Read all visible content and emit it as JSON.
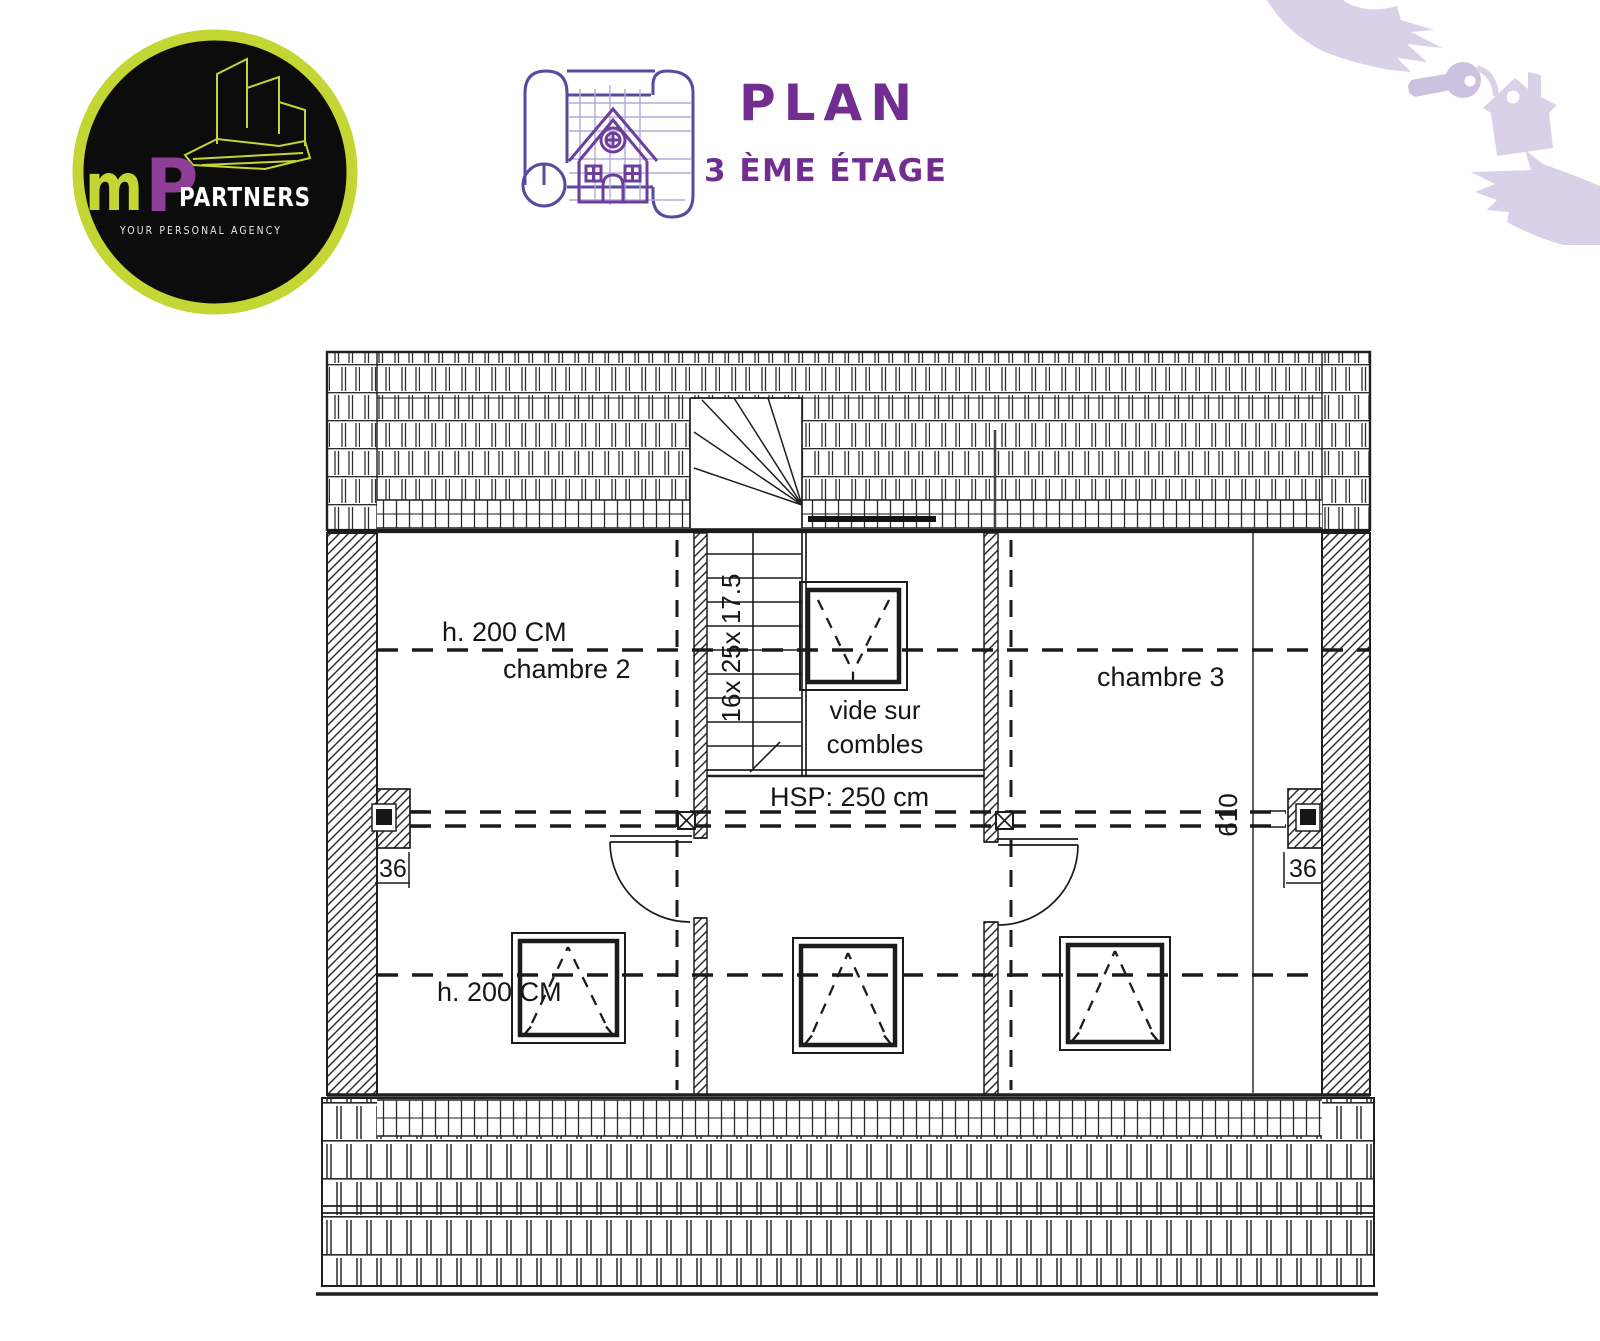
{
  "brand": {
    "m": "m",
    "p": "P",
    "name": "PARTNERS",
    "tagline": "YOUR PERSONAL AGENCY"
  },
  "header": {
    "title": "PLAN",
    "subtitle": "3 ÈME ÉTAGE"
  },
  "plan": {
    "room2": {
      "height_label": "h. 200 CM",
      "name": "chambre 2"
    },
    "room3": {
      "name": "chambre 3"
    },
    "void": {
      "line1": "vide sur",
      "line2": "combles"
    },
    "hall": {
      "ceiling": "HSP: 250 cm"
    },
    "stairs": {
      "dim": "16x 25x 17.5"
    },
    "dims": {
      "left_wall": "36",
      "right_wall": "36",
      "depth": "610",
      "lower_height": "h. 200 CM"
    }
  },
  "colors": {
    "title_purple": "#722d91",
    "blueprint_icon_purple": "#5a49a0",
    "house_purple": "#6d3e9c",
    "logo_ring_lime": "#c3d633",
    "logo_p_purple": "#8f3f97",
    "logo_background": "#0c0c0c",
    "illustration_lavender": "#d8d1e8",
    "drawing_ink": "#1c1c1c"
  }
}
